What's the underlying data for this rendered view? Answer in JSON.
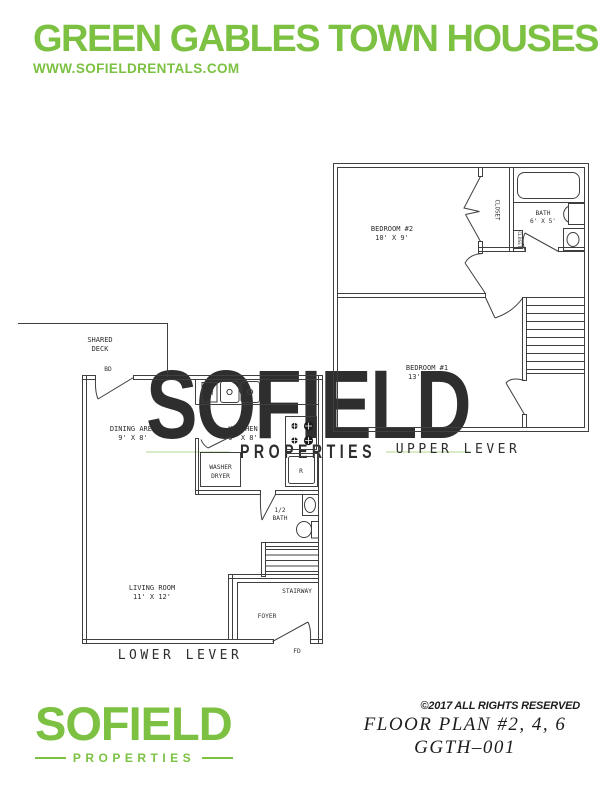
{
  "header": {
    "title": "GREEN GABLES TOWN HOUSES",
    "website": "WWW.SOFIELDRENTALS.COM"
  },
  "watermark": {
    "name": "SOFIELD",
    "tagline": "PROPERTIES"
  },
  "upper_plan": {
    "title": "UPPER LEVER",
    "rooms": {
      "bedroom2": {
        "name": "BEDROOM #2",
        "dims": "10' X 9'"
      },
      "bedroom1": {
        "name": "BEDROOM #1",
        "dims": "13' X 11'"
      },
      "bath": {
        "name": "BATH",
        "dims": "6' X 5'"
      },
      "closet": "CLOSET",
      "closet_small": "CLOSET"
    }
  },
  "lower_plan": {
    "title": "LOWER LEVER",
    "rooms": {
      "shared_deck_line1": "SHARED",
      "shared_deck_line2": "DECK",
      "deck_door": "BD",
      "dining": {
        "name": "DINING AREA",
        "dims": "9' X 8'"
      },
      "kitchen": {
        "name": "KITCHEN",
        "dims": "9' X 8'"
      },
      "dishwasher": "DW",
      "washer_line1": "WASHER",
      "washer_line2": "DRYER",
      "refrigerator": "R",
      "half_bath_line1": "1/2",
      "half_bath_line2": "BATH",
      "living": {
        "name": "LIVING ROOM",
        "dims": "11' X 12'"
      },
      "stairway": "STAIRWAY",
      "foyer": "FOYER",
      "front_door": "FD"
    }
  },
  "footer": {
    "logo_name": "SOFIELD",
    "logo_tagline": "PROPERTIES",
    "copyright": "©2017 ALL RIGHTS RESERVED",
    "plan_title": "FLOOR PLAN #2, 4, 6",
    "plan_code": "GGTH–001"
  },
  "colors": {
    "brand_green": "#7CC142",
    "watermark_green": "rgba(124,193,66,0.24)",
    "plan_line": "#3f3f3f"
  }
}
